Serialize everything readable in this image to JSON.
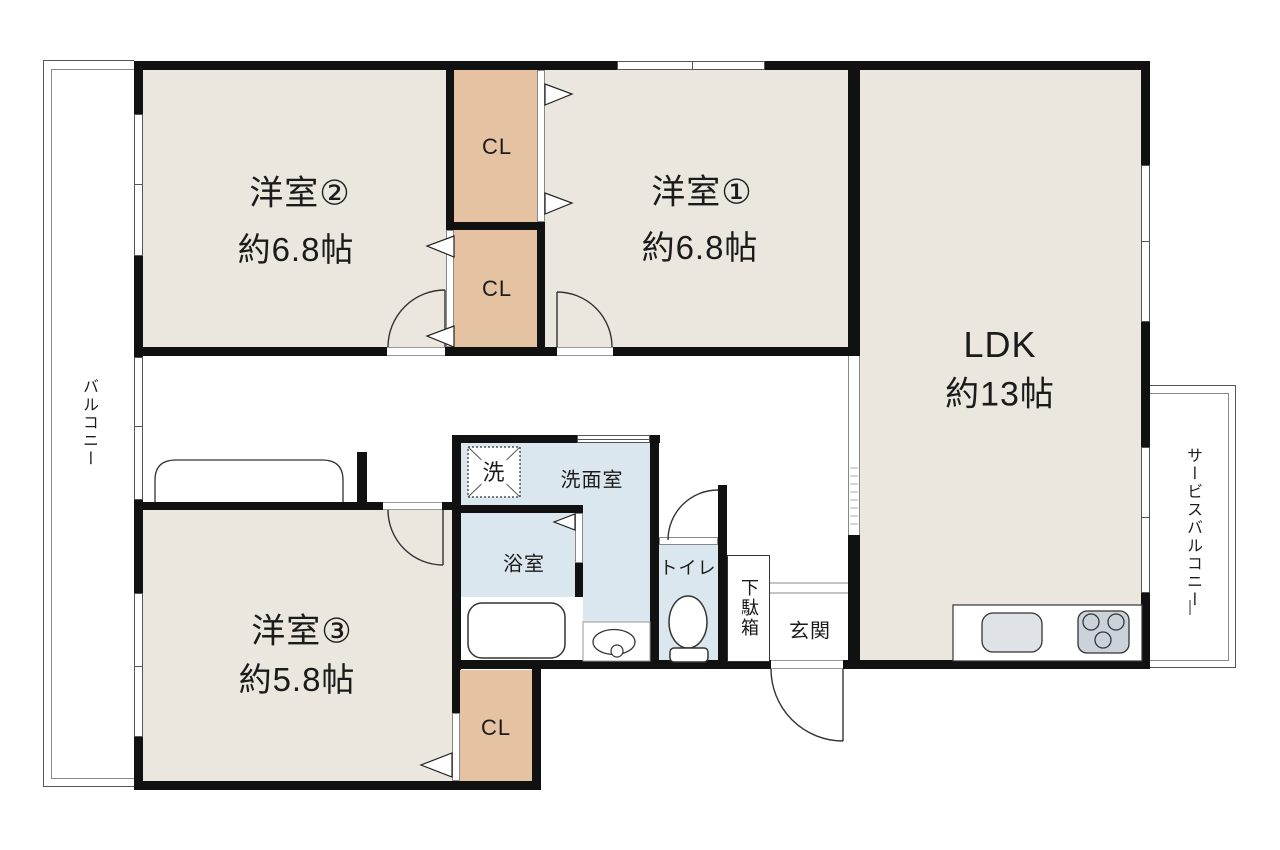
{
  "plan": {
    "title": "間取り図",
    "rooms": {
      "western2": {
        "label": "洋室②",
        "area": "約6.8帖"
      },
      "western1": {
        "label": "洋室①",
        "area": "約6.8帖"
      },
      "western3": {
        "label": "洋室③",
        "area": "約5.8帖"
      },
      "ldk": {
        "label": "LDK",
        "area": "約13帖"
      },
      "washroom": {
        "label": "洗面室"
      },
      "bathroom": {
        "label": "浴室"
      },
      "toilet": {
        "label": "トイレ"
      },
      "entrance": {
        "label": "玄関"
      },
      "shoe_cabinet": {
        "label": "下駄箱"
      },
      "balcony": {
        "label": "バルコニー"
      },
      "service_balcony": {
        "label": "サービスバルコニー"
      },
      "closet_top": {
        "label": "CL"
      },
      "closet_mid": {
        "label": "CL"
      },
      "closet_bottom": {
        "label": "CL"
      },
      "washer": {
        "label": "洗"
      }
    },
    "colors": {
      "room_floor": "#ebe6de",
      "closet": "#e4c2a2",
      "wet_area": "#dbe7ee",
      "wall": "#111111",
      "sink": "#dfe3e8",
      "stove": "#ccd2d9"
    }
  }
}
